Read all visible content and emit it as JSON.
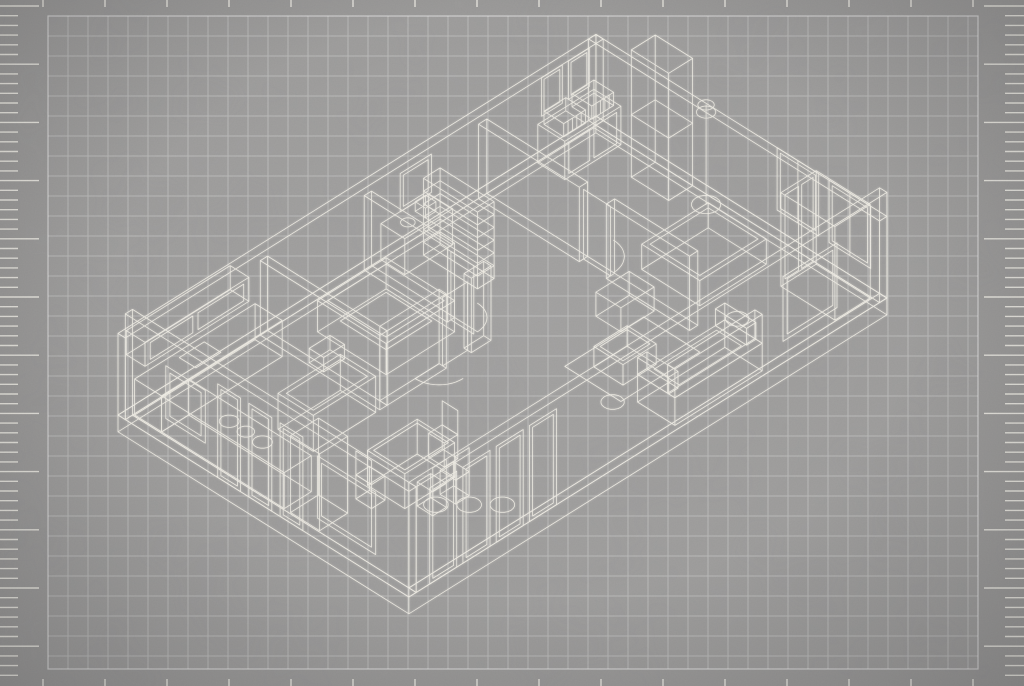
{
  "canvas": {
    "width": 1024,
    "height": 686
  },
  "palette": {
    "background": "#9a9998",
    "grid_area_tint": "rgba(255,255,255,0.035)",
    "grid_line": "rgba(255,255,255,0.30)",
    "grid_border": "rgba(255,255,255,0.55)",
    "tick_color": "rgba(243,240,232,0.88)",
    "wire_color": "#f6f3ea"
  },
  "grid": {
    "x0": 48,
    "y0": 16,
    "x1": 978,
    "y1": 669,
    "cell": 20
  },
  "rulers": {
    "left": {
      "edge_x": 0,
      "y_start": 6,
      "y_end": 680,
      "step": 9.7,
      "short_len": 18,
      "long_len": 39,
      "major_every": 6
    },
    "right": {
      "edge_x": 1024,
      "y_start": 6,
      "y_end": 680,
      "step": 9.7,
      "short_len": 19,
      "long_len": 40,
      "major_every": 6
    },
    "top": {
      "edge_y": 0,
      "len": 7,
      "x_start": 43,
      "x_end": 976,
      "step": 62
    },
    "bottom": {
      "edge_y": 686,
      "len": 7,
      "x_start": 43,
      "x_end": 976,
      "step": 62
    }
  },
  "projection": {
    "ox": 118,
    "oy": 415,
    "c": 20.78,
    "h": 13,
    "k": 24
  },
  "scene": [
    {
      "n": "floor-slab",
      "t": "box",
      "p": [
        0,
        0,
        -0.7,
        23,
        14,
        0
      ]
    },
    {
      "n": "floor-inset",
      "t": "rectH",
      "p": [
        0.35,
        0.35,
        22.65,
        13.65,
        0
      ]
    },
    {
      "n": "wall-back-left",
      "t": "box",
      "p": [
        0,
        0,
        0,
        23,
        0.35,
        3.4
      ]
    },
    {
      "n": "wall-back-right",
      "t": "box",
      "p": [
        22.65,
        0,
        0,
        23,
        14,
        3.4
      ]
    },
    {
      "n": "wall-front-left",
      "t": "box",
      "p": [
        0,
        0.35,
        0,
        0.35,
        14,
        4.4
      ]
    },
    {
      "n": "wall-front-right",
      "t": "box",
      "p": [
        0.35,
        13.65,
        0,
        23,
        14,
        4.4
      ]
    },
    {
      "n": "partition-kitchen",
      "t": "box",
      "p": [
        6.5,
        0.35,
        0,
        6.85,
        6.1,
        3.1
      ]
    },
    {
      "n": "partition-bath-front-left",
      "t": "box",
      "p": [
        6.85,
        5.75,
        0,
        9.7,
        6.1,
        3.1
      ]
    },
    {
      "n": "partition-bath-front-right",
      "t": "box",
      "p": [
        10.9,
        5.75,
        0,
        11.85,
        6.1,
        3.1
      ]
    },
    {
      "n": "partition-bath-right",
      "t": "box",
      "p": [
        11.5,
        0.35,
        0,
        11.85,
        4.35,
        3.1
      ]
    },
    {
      "n": "partition-bedroom",
      "t": "box",
      "p": [
        17,
        0.35,
        0,
        17.4,
        5.2,
        3.1
      ]
    },
    {
      "n": "partition-bedroom-front",
      "t": "box",
      "p": [
        17,
        6.5,
        0,
        17.4,
        10.5,
        3.1
      ]
    },
    {
      "n": "door-frame-bath",
      "t": "rectV",
      "p": [
        4.35,
        5.45,
        11.67,
        0,
        2.85
      ]
    },
    {
      "n": "door-swing-bath",
      "t": "arc",
      "p": [
        11.85,
        4.35,
        0,
        1.1,
        0,
        90
      ]
    },
    {
      "n": "door-frame-bath-front",
      "t": "rectU",
      "p": [
        9.7,
        10.9,
        5.92,
        0,
        2.85
      ]
    },
    {
      "n": "door-swing-bath-front",
      "t": "arc",
      "p": [
        9.7,
        5.75,
        0,
        1.15,
        90,
        180
      ]
    },
    {
      "n": "door-frame-bedroom",
      "t": "rectV",
      "p": [
        5.2,
        6.5,
        17.2,
        0,
        2.9
      ]
    },
    {
      "n": "door-swing-bedroom",
      "t": "arc",
      "p": [
        17.4,
        5.2,
        0,
        1.25,
        0,
        90
      ]
    },
    {
      "n": "window-kitchen-left",
      "t": "rectV",
      "p": [
        2.3,
        4.2,
        0,
        1.1,
        3.3
      ]
    },
    {
      "n": "window-kitchen-left-inner",
      "t": "rectV",
      "p": [
        2.5,
        4.0,
        0,
        1.3,
        3.1
      ]
    },
    {
      "n": "entry-door-1",
      "t": "rectV",
      "p": [
        4.8,
        5.9,
        0,
        0,
        3.9
      ]
    },
    {
      "n": "entry-door-1-inner",
      "t": "rectV",
      "p": [
        4.95,
        5.75,
        0,
        0.15,
        3.75
      ]
    },
    {
      "n": "entry-door-2",
      "t": "rectV",
      "p": [
        6.3,
        7.4,
        0,
        0,
        3.9
      ]
    },
    {
      "n": "entry-door-2-inner",
      "t": "rectV",
      "p": [
        6.45,
        7.25,
        0,
        0.15,
        3.75
      ]
    },
    {
      "n": "entry-door-3",
      "t": "rectV",
      "p": [
        7.8,
        8.9,
        0,
        0,
        3.9
      ]
    },
    {
      "n": "entry-door-3-inner",
      "t": "rectV",
      "p": [
        7.95,
        8.75,
        0,
        0.15,
        3.75
      ]
    },
    {
      "n": "window-left",
      "t": "rectV",
      "p": [
        9.6,
        12.4,
        0,
        0.9,
        3.5
      ]
    },
    {
      "n": "window-left-inner",
      "t": "rectV",
      "p": [
        9.8,
        12.2,
        0,
        1.1,
        3.3
      ]
    },
    {
      "n": "glass-door-1",
      "t": "rectU",
      "p": [
        1.0,
        2.3,
        14,
        0,
        4.0
      ]
    },
    {
      "n": "glass-door-1-inner",
      "t": "rectU",
      "p": [
        1.15,
        2.15,
        14,
        0.15,
        3.85
      ]
    },
    {
      "n": "glass-door-2",
      "t": "rectU",
      "p": [
        2.6,
        3.9,
        14,
        0,
        4.0
      ]
    },
    {
      "n": "glass-door-2-inner",
      "t": "rectU",
      "p": [
        2.75,
        3.75,
        14,
        0.15,
        3.85
      ]
    },
    {
      "n": "glass-door-3",
      "t": "rectU",
      "p": [
        4.2,
        5.5,
        14,
        0,
        4.0
      ]
    },
    {
      "n": "glass-door-3-inner",
      "t": "rectU",
      "p": [
        4.35,
        5.35,
        14,
        0.15,
        3.85
      ]
    },
    {
      "n": "glass-door-4",
      "t": "rectU",
      "p": [
        5.8,
        7.1,
        14,
        0,
        4.0
      ]
    },
    {
      "n": "glass-door-4-inner",
      "t": "rectU",
      "p": [
        5.95,
        6.95,
        14,
        0.15,
        3.85
      ]
    },
    {
      "n": "window-front-right",
      "t": "rectU",
      "p": [
        18.0,
        20.6,
        14,
        0.9,
        3.6
      ]
    },
    {
      "n": "window-front-right-inner",
      "t": "rectU",
      "p": [
        18.2,
        20.4,
        14,
        1.1,
        3.4
      ]
    },
    {
      "n": "window-back-1",
      "t": "rectV",
      "p": [
        8.9,
        10.9,
        22.82,
        1.0,
        3.6
      ]
    },
    {
      "n": "window-back-1-inner",
      "t": "rectV",
      "p": [
        9.05,
        10.75,
        22.82,
        1.15,
        3.45
      ]
    },
    {
      "n": "window-back-1-mullion",
      "t": "line",
      "p": [
        22.82,
        9.9,
        1.0,
        22.82,
        9.9,
        3.6
      ]
    },
    {
      "n": "window-back-2",
      "t": "rectV",
      "p": [
        11.4,
        13.4,
        22.82,
        1.0,
        3.6
      ]
    },
    {
      "n": "window-back-2-inner",
      "t": "rectV",
      "p": [
        11.55,
        13.25,
        22.82,
        1.15,
        3.45
      ]
    },
    {
      "n": "window-back-2-mullion",
      "t": "line",
      "p": [
        22.82,
        12.4,
        1.0,
        22.82,
        12.4,
        3.6
      ]
    },
    {
      "n": "window-bedroom-1",
      "t": "rectU",
      "p": [
        20.2,
        21.2,
        0.18,
        1.6,
        3.2
      ]
    },
    {
      "n": "window-bedroom-1-inner",
      "t": "rectU",
      "p": [
        20.32,
        21.08,
        0.18,
        1.72,
        3.08
      ]
    },
    {
      "n": "window-bedroom-2",
      "t": "rectU",
      "p": [
        21.5,
        22.5,
        0.18,
        1.6,
        3.2
      ]
    },
    {
      "n": "window-bedroom-2-inner",
      "t": "rectU",
      "p": [
        21.62,
        22.38,
        0.18,
        1.72,
        3.08
      ]
    },
    {
      "n": "wall-frame-hall",
      "t": "rectU",
      "p": [
        13.4,
        14.9,
        0.18,
        1.3,
        2.9
      ]
    },
    {
      "n": "wall-frame-hall-inner",
      "t": "rectU",
      "p": [
        13.55,
        14.75,
        0.18,
        1.45,
        2.75
      ]
    },
    {
      "n": "kitchen-counter-back",
      "t": "box",
      "p": [
        0.4,
        0.4,
        0,
        6.2,
        1.7,
        1.5
      ]
    },
    {
      "n": "kitchen-counter-left",
      "t": "box",
      "p": [
        0.4,
        1.7,
        0,
        1.7,
        7.6,
        1.5
      ]
    },
    {
      "n": "kitchen-upper-cabinets",
      "t": "box",
      "p": [
        0.4,
        0,
        2.3,
        5.4,
        0.9,
        3.3
      ]
    },
    {
      "n": "cabinet-doors-1",
      "t": "rectU",
      "p": [
        0.65,
        2.7,
        0.9,
        2.45,
        3.15
      ]
    },
    {
      "n": "cabinet-doors-2",
      "t": "rectU",
      "p": [
        2.95,
        5.15,
        0.9,
        2.45,
        3.15
      ]
    },
    {
      "n": "kitchen-island",
      "t": "box",
      "p": [
        3.3,
        4.4,
        0,
        6.3,
        6.1,
        1.5
      ]
    },
    {
      "n": "kitchen-island-top",
      "t": "rectH",
      "p": [
        3.5,
        4.6,
        6.1,
        5.9,
        1.5
      ]
    },
    {
      "n": "range-hood",
      "t": "box",
      "p": [
        4.3,
        4.9,
        2.5,
        5.3,
        5.6,
        3.1
      ]
    },
    {
      "n": "kitchen-sink",
      "t": "rectH",
      "p": [
        2.3,
        0.65,
        3.5,
        1.45,
        1.5
      ]
    },
    {
      "n": "dish-1",
      "t": "ell",
      "p": [
        1.05,
        4.3,
        1.5,
        0.34
      ]
    },
    {
      "n": "dish-2",
      "t": "ell",
      "p": [
        1.05,
        5.1,
        1.5,
        0.3
      ]
    },
    {
      "n": "dish-3",
      "t": "ell",
      "p": [
        1.05,
        5.9,
        1.5,
        0.34
      ]
    },
    {
      "n": "fridge",
      "t": "box",
      "p": [
        0.4,
        7.9,
        0,
        1.75,
        9.3,
        3.2
      ]
    },
    {
      "n": "dining-table",
      "t": "box",
      "p": [
        3.3,
        8.7,
        0,
        5.7,
        10.5,
        1.45
      ]
    },
    {
      "n": "dining-table-top",
      "t": "rectH",
      "p": [
        3.45,
        8.85,
        5.55,
        10.35,
        1.45
      ]
    },
    {
      "n": "chair-1-seat",
      "t": "box",
      "p": [
        2.5,
        8.95,
        0,
        3.15,
        9.7,
        1.0
      ]
    },
    {
      "n": "chair-1-back",
      "t": "rectV",
      "p": [
        8.95,
        9.7,
        2.5,
        1.0,
        2.0
      ]
    },
    {
      "n": "chair-2-seat",
      "t": "box",
      "p": [
        5.85,
        9.1,
        0,
        6.5,
        9.85,
        1.0
      ]
    },
    {
      "n": "chair-2-back",
      "t": "rectV",
      "p": [
        9.1,
        9.85,
        6.5,
        1.0,
        2.0
      ]
    },
    {
      "n": "chair-3-seat",
      "t": "box",
      "p": [
        3.7,
        10.7,
        0,
        4.35,
        11.45,
        1.0
      ]
    },
    {
      "n": "chair-3-back",
      "t": "rectU",
      "p": [
        3.7,
        4.35,
        11.45,
        1.0,
        2.0
      ]
    },
    {
      "n": "chair-4-seat",
      "t": "box",
      "p": [
        4.7,
        10.8,
        0,
        5.35,
        11.55,
        1.0
      ]
    },
    {
      "n": "chair-4-back",
      "t": "rectU",
      "p": [
        4.7,
        5.35,
        11.55,
        1.0,
        2.0
      ]
    },
    {
      "n": "bathtub",
      "t": "box",
      "p": [
        8.0,
        1.6,
        0,
        11.3,
        4.9,
        1.3
      ]
    },
    {
      "n": "bathtub-rim",
      "t": "rectH",
      "p": [
        8.25,
        1.85,
        11.05,
        4.65,
        1.3
      ]
    },
    {
      "n": "bathtub-basin",
      "t": "rectH",
      "p": [
        8.55,
        2.15,
        10.75,
        4.35,
        0.45
      ]
    },
    {
      "n": "shelf-unit",
      "t": "shelves",
      "p": [
        13.5,
        1.2,
        14.3,
        3.8,
        0,
        3.2,
        6
      ]
    },
    {
      "n": "sideboard",
      "t": "box",
      "p": [
        12.3,
        0.35,
        0,
        14.6,
        1.5,
        1.5
      ]
    },
    {
      "n": "sideboard-vase",
      "t": "ell",
      "p": [
        13.0,
        0.95,
        1.5,
        0.25
      ]
    },
    {
      "n": "sideboard-box",
      "t": "box",
      "p": [
        13.6,
        0.7,
        1.5,
        14.1,
        1.2,
        1.9
      ]
    },
    {
      "n": "dresser",
      "t": "box",
      "p": [
        19.8,
        0.4,
        0,
        22.5,
        1.7,
        1.6
      ]
    },
    {
      "n": "dresser-door-1",
      "t": "rectU",
      "p": [
        20.0,
        21.0,
        1.7,
        0.15,
        1.45
      ]
    },
    {
      "n": "dresser-door-2",
      "t": "rectU",
      "p": [
        21.2,
        22.3,
        1.7,
        0.15,
        1.45
      ]
    },
    {
      "n": "basket-1",
      "t": "basket",
      "p": [
        19.95,
        0.55,
        21.0,
        1.5,
        1.6,
        2.15
      ]
    },
    {
      "n": "basket-2",
      "t": "basket",
      "p": [
        21.3,
        0.55,
        22.35,
        1.5,
        1.6,
        2.15
      ]
    },
    {
      "n": "tall-wardrobe",
      "t": "box",
      "p": [
        21.5,
        3.2,
        0,
        22.65,
        5.0,
        5.3
      ]
    },
    {
      "n": "tall-wardrobe-shelf",
      "t": "rectH",
      "p": [
        21.5,
        3.2,
        22.65,
        5.0,
        2.6
      ]
    },
    {
      "n": "wardrobe",
      "t": "box",
      "p": [
        20.9,
        11.0,
        0,
        22.6,
        13.6,
        3.9
      ]
    },
    {
      "n": "wardrobe-door-1",
      "t": "rectU",
      "p": [
        21.1,
        21.75,
        11.0,
        0.2,
        3.7
      ]
    },
    {
      "n": "wardrobe-door-2",
      "t": "rectU",
      "p": [
        21.9,
        22.45,
        11.0,
        0.2,
        3.7
      ]
    },
    {
      "n": "bed",
      "t": "box",
      "p": [
        18.2,
        7.0,
        0,
        21.4,
        9.8,
        1.05
      ]
    },
    {
      "n": "bed-mattress",
      "t": "rectH",
      "p": [
        18.4,
        7.2,
        21.2,
        9.6,
        1.05
      ]
    },
    {
      "n": "bench",
      "t": "box",
      "p": [
        15.3,
        7.7,
        0,
        16.9,
        8.9,
        1.0
      ]
    },
    {
      "n": "living-rug",
      "t": "rectH",
      "p": [
        12.6,
        8.9,
        16.4,
        11.6,
        0.02
      ]
    },
    {
      "n": "sofa-base",
      "t": "box",
      "p": [
        13.0,
        12.0,
        0,
        17.2,
        13.8,
        1.15
      ]
    },
    {
      "n": "sofa-back",
      "t": "box",
      "p": [
        13.0,
        13.45,
        1.15,
        17.2,
        13.8,
        2.35
      ]
    },
    {
      "n": "sofa-arm-left",
      "t": "box",
      "p": [
        13.0,
        12.0,
        1.15,
        13.45,
        13.5,
        1.85
      ]
    },
    {
      "n": "sofa-arm-right",
      "t": "box",
      "p": [
        16.75,
        12.0,
        1.15,
        17.2,
        13.5,
        1.85
      ]
    },
    {
      "n": "sofa-cushions",
      "t": "rectH",
      "p": [
        13.6,
        12.2,
        16.6,
        13.4,
        1.15
      ]
    },
    {
      "n": "coffee-table",
      "t": "box",
      "p": [
        13.3,
        9.6,
        0,
        14.9,
        11.0,
        0.85
      ]
    },
    {
      "n": "coffee-table-top",
      "t": "rectH",
      "p": [
        13.45,
        9.75,
        14.75,
        10.85,
        0.85
      ]
    },
    {
      "n": "floor-lamp-pole",
      "t": "line",
      "p": [
        22.2,
        6.1,
        0.05,
        22.2,
        6.1,
        4.2
      ]
    },
    {
      "n": "floor-lamp-base",
      "t": "ell",
      "p": [
        22.2,
        6.1,
        0.05,
        0.5
      ]
    },
    {
      "n": "floor-lamp-shade-top",
      "t": "ell",
      "p": [
        22.2,
        6.1,
        4.2,
        0.28
      ]
    },
    {
      "n": "floor-lamp-shade-bottom",
      "t": "ell",
      "p": [
        22.2,
        6.1,
        3.9,
        0.33
      ]
    },
    {
      "n": "ceiling-light-1",
      "t": "ell",
      "p": [
        4.2,
        11.1,
        0,
        0.42
      ]
    },
    {
      "n": "ceiling-light-2",
      "t": "ell",
      "p": [
        5.0,
        11.9,
        0,
        0.42
      ]
    },
    {
      "n": "ceiling-light-3",
      "t": "ell",
      "p": [
        5.8,
        12.7,
        0,
        0.42
      ]
    },
    {
      "n": "ceiling-light-4",
      "t": "ell",
      "p": [
        12.4,
        11.4,
        0,
        0.4
      ]
    },
    {
      "n": "ceiling-light-5",
      "t": "ell",
      "p": [
        18.6,
        11.2,
        0,
        0.4
      ]
    }
  ]
}
